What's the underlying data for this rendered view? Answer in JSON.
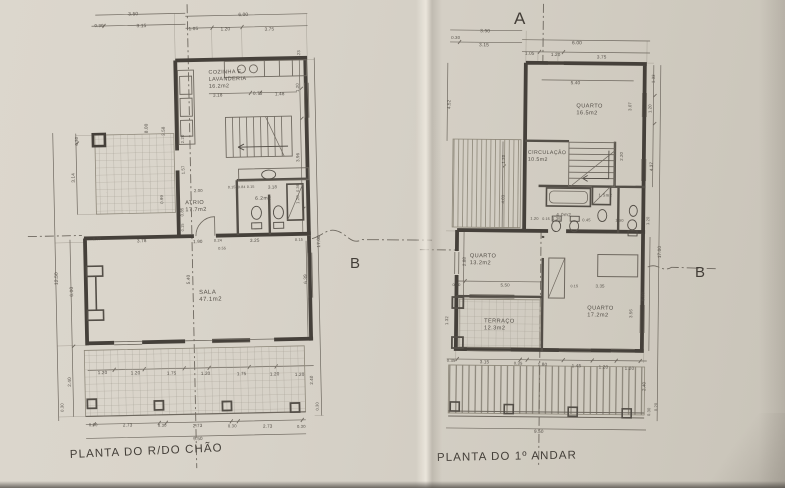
{
  "drawing": {
    "ink_color": "#45403a",
    "paper_color": "#d5cfc5"
  },
  "ground_floor": {
    "title": "PLANTA DO R/DO CHÃO",
    "section_marker_b": "B",
    "room_labels": [
      {
        "lines": [
          "COZINHA  E",
          "LAVANDERIA",
          "16.2m2"
        ],
        "x": 212,
        "y": 74,
        "s": 5.4
      },
      {
        "lines": [
          "ATRIO",
          "17.7m2"
        ],
        "x": 186,
        "y": 204,
        "s": 5.6
      },
      {
        "lines": [
          "6.2m2"
        ],
        "x": 256,
        "y": 201,
        "s": 5
      },
      {
        "lines": [
          "SALA",
          "47.1m2"
        ],
        "x": 198,
        "y": 294,
        "s": 6
      }
    ],
    "dim_labels": [
      {
        "t": "3.50",
        "x": 133,
        "y": 14,
        "s": 4.8
      },
      {
        "t": "0.30",
        "x": 99,
        "y": 25,
        "s": 4.4
      },
      {
        "t": "3.15",
        "x": 141,
        "y": 26,
        "s": 4.8
      },
      {
        "t": "6.00",
        "x": 243,
        "y": 17,
        "s": 4.8
      },
      {
        "t": "1.05",
        "x": 193,
        "y": 30,
        "s": 4.6
      },
      {
        "t": "1.20",
        "x": 225,
        "y": 31,
        "s": 4.6
      },
      {
        "t": "3.75",
        "x": 269,
        "y": 32,
        "s": 4.6
      },
      {
        "t": "12.50",
        "x": 57,
        "y": 282,
        "r": -90,
        "s": 4.8
      },
      {
        "t": "6.00",
        "x": 72,
        "y": 294,
        "r": -90,
        "s": 4.8
      },
      {
        "t": "2.40",
        "x": 68,
        "y": 384,
        "r": -90,
        "s": 4.6
      },
      {
        "t": "0.30",
        "x": 60,
        "y": 409,
        "r": -90,
        "s": 4.2
      },
      {
        "t": "0.30",
        "x": 80,
        "y": 143,
        "r": -90,
        "s": 4.2
      },
      {
        "t": "3.14",
        "x": 76,
        "y": 180,
        "r": -90,
        "s": 4.6
      },
      {
        "t": "8.00",
        "x": 150,
        "y": 132,
        "r": -90,
        "s": 4.6
      },
      {
        "t": "3.58",
        "x": 167,
        "y": 135,
        "r": -90,
        "s": 4.4
      },
      {
        "t": "0.99",
        "x": 164,
        "y": 203,
        "r": -90,
        "s": 4.2
      },
      {
        "t": "2.20",
        "x": 186,
        "y": 143,
        "r": -90,
        "s": 4.2
      },
      {
        "t": "1.57",
        "x": 186,
        "y": 174,
        "r": -90,
        "s": 4.2
      },
      {
        "t": "2.00",
        "x": 195,
        "y": 192,
        "s": 4.2
      },
      {
        "t": "0.85",
        "x": 184,
        "y": 216,
        "r": -90,
        "s": 4.2
      },
      {
        "t": "0.15",
        "x": 184,
        "y": 231,
        "r": -90,
        "s": 3.8
      },
      {
        "t": "3.18",
        "x": 216,
        "y": 97,
        "s": 4.6
      },
      {
        "t": "0.75",
        "x": 256,
        "y": 96,
        "s": 4.6
      },
      {
        "t": "1.48",
        "x": 278,
        "y": 97,
        "s": 4.6
      },
      {
        "t": "1.23",
        "x": 304,
        "y": 61,
        "r": -90,
        "s": 4.2
      },
      {
        "t": "1.20",
        "x": 302,
        "y": 94,
        "r": -90,
        "s": 4.2
      },
      {
        "t": "3.96",
        "x": 301,
        "y": 164,
        "r": -90,
        "s": 4.4
      },
      {
        "t": "1.20",
        "x": 300,
        "y": 206,
        "r": -90,
        "s": 4.2
      },
      {
        "t": "0.15",
        "x": 229,
        "y": 189,
        "s": 3.6
      },
      {
        "t": "0.84",
        "x": 239,
        "y": 189,
        "s": 3.6
      },
      {
        "t": "0.15",
        "x": 248,
        "y": 189,
        "s": 3.6
      },
      {
        "t": "3.18",
        "x": 269,
        "y": 190,
        "s": 4.4
      },
      {
        "t": "0.36",
        "x": 300,
        "y": 194,
        "r": -90,
        "s": 3.8
      },
      {
        "t": "0.30",
        "x": 93,
        "y": 238,
        "s": 3.8
      },
      {
        "t": "3.78",
        "x": 137,
        "y": 241,
        "s": 4.6
      },
      {
        "t": "1.90",
        "x": 193,
        "y": 243,
        "s": 4.6
      },
      {
        "t": "0.24",
        "x": 214,
        "y": 242,
        "s": 3.8
      },
      {
        "t": "0.55",
        "x": 218,
        "y": 250,
        "s": 3.8
      },
      {
        "t": "3.25",
        "x": 250,
        "y": 243,
        "s": 4.6
      },
      {
        "t": "0.15",
        "x": 295,
        "y": 243,
        "s": 3.8
      },
      {
        "t": "5.40",
        "x": 189,
        "y": 284,
        "r": -90,
        "s": 4.6
      },
      {
        "t": "6.39",
        "x": 306,
        "y": 286,
        "r": -90,
        "s": 4.6
      },
      {
        "t": "1.20",
        "x": 95,
        "y": 372,
        "s": 4.6
      },
      {
        "t": "1.20",
        "x": 128,
        "y": 373,
        "s": 4.6
      },
      {
        "t": "1.75",
        "x": 164,
        "y": 374,
        "s": 4.6
      },
      {
        "t": "1.20",
        "x": 198,
        "y": 375,
        "s": 4.6
      },
      {
        "t": "1.75",
        "x": 234,
        "y": 376,
        "s": 4.6
      },
      {
        "t": "1.20",
        "x": 267,
        "y": 377,
        "s": 4.6
      },
      {
        "t": "1.20",
        "x": 292,
        "y": 378,
        "s": 4.6
      },
      {
        "t": "0.30",
        "x": 85,
        "y": 424,
        "s": 4.2
      },
      {
        "t": "2.73",
        "x": 119,
        "y": 425,
        "s": 4.6
      },
      {
        "t": "0.30",
        "x": 154,
        "y": 426,
        "s": 4.2
      },
      {
        "t": "2.73",
        "x": 189,
        "y": 427,
        "s": 4.6
      },
      {
        "t": "0.30",
        "x": 224,
        "y": 428,
        "s": 4.2
      },
      {
        "t": "2.73",
        "x": 259,
        "y": 429,
        "s": 4.6
      },
      {
        "t": "0.30",
        "x": 293,
        "y": 430,
        "s": 4.2
      },
      {
        "t": "9.50",
        "x": 189,
        "y": 440,
        "s": 4.6
      },
      {
        "t": "17.00",
        "x": 320,
        "y": 250,
        "r": -90,
        "s": 4.6
      },
      {
        "t": "2.40",
        "x": 310,
        "y": 387,
        "r": -90,
        "s": 4.4
      },
      {
        "t": "0.30",
        "x": 315,
        "y": 413,
        "r": -90,
        "s": 4
      }
    ]
  },
  "first_floor": {
    "title": "PLANTA DO 1º ANDAR",
    "section_marker_a": "A",
    "section_marker_b": "B",
    "room_labels": [
      {
        "lines": [
          "QUARTO",
          "16.5m2"
        ],
        "x": 575,
        "y": 107,
        "s": 5.6
      },
      {
        "lines": [
          "CIRCULAÇÃO",
          "10.5m2"
        ],
        "x": 527,
        "y": 154,
        "s": 5.2
      },
      {
        "lines": [
          "4.0m2"
        ],
        "x": 556,
        "y": 216,
        "s": 4.6
      },
      {
        "lines": [
          "1.5m2"
        ],
        "x": 598,
        "y": 196,
        "s": 4.2
      },
      {
        "lines": [
          "QUARTO",
          "13.2m2"
        ],
        "x": 470,
        "y": 258,
        "s": 5.6
      },
      {
        "lines": [
          "TERRAÇO",
          "12.3m2"
        ],
        "x": 485,
        "y": 323,
        "s": 5.6
      },
      {
        "lines": [
          "QUARTO",
          "17.2m2"
        ],
        "x": 588,
        "y": 309,
        "s": 5.6
      }
    ],
    "dim_labels": [
      {
        "t": "3.50",
        "x": 478,
        "y": 33,
        "s": 4.8
      },
      {
        "t": "0.30",
        "x": 449,
        "y": 40,
        "s": 4.4
      },
      {
        "t": "3.15",
        "x": 477,
        "y": 47,
        "s": 4.8
      },
      {
        "t": "6.00",
        "x": 570,
        "y": 44,
        "s": 4.8
      },
      {
        "t": "1.05",
        "x": 523,
        "y": 55,
        "s": 4.6
      },
      {
        "t": "1.20",
        "x": 549,
        "y": 56,
        "s": 4.6
      },
      {
        "t": "3.75",
        "x": 595,
        "y": 58,
        "s": 4.6
      },
      {
        "t": "5.40",
        "x": 569,
        "y": 84,
        "s": 4.6
      },
      {
        "t": "1.33",
        "x": 653,
        "y": 82,
        "r": -90,
        "s": 4.2
      },
      {
        "t": "1.20",
        "x": 650,
        "y": 112,
        "r": -90,
        "s": 4.2
      },
      {
        "t": "3.07",
        "x": 630,
        "y": 110,
        "r": -90,
        "s": 4.2
      },
      {
        "t": "4.37",
        "x": 652,
        "y": 170,
        "r": -90,
        "s": 4.4
      },
      {
        "t": "17.00",
        "x": 661,
        "y": 257,
        "r": -90,
        "s": 4.6
      },
      {
        "t": "6.00",
        "x": 645,
        "y": 300,
        "r": -90,
        "s": 4.4
      },
      {
        "t": "3.56",
        "x": 633,
        "y": 317,
        "r": -90,
        "s": 4.2
      },
      {
        "t": "2.40",
        "x": 647,
        "y": 390,
        "r": -90,
        "s": 4.4
      },
      {
        "t": "0.30",
        "x": 652,
        "y": 415,
        "r": -90,
        "s": 4
      },
      {
        "t": "0.20",
        "x": 659,
        "y": 410,
        "r": -90,
        "s": 4
      },
      {
        "t": "4.52",
        "x": 449,
        "y": 110,
        "r": -90,
        "s": 4.4
      },
      {
        "t": "1.20",
        "x": 504,
        "y": 164,
        "r": -90,
        "s": 4.2
      },
      {
        "t": "4.03",
        "x": 504,
        "y": 204,
        "r": -90,
        "s": 4.2
      },
      {
        "t": "2.88",
        "x": 466,
        "y": 267,
        "r": -90,
        "s": 4.4
      },
      {
        "t": "1.32",
        "x": 449,
        "y": 326,
        "r": -90,
        "s": 4.2
      },
      {
        "t": "0.30",
        "x": 453,
        "y": 287,
        "s": 3.8
      },
      {
        "t": "5.50",
        "x": 501,
        "y": 287,
        "s": 4.4
      },
      {
        "t": "2.20",
        "x": 622,
        "y": 160,
        "r": -90,
        "s": 4.2
      },
      {
        "t": "1.20",
        "x": 530,
        "y": 220,
        "s": 4
      },
      {
        "t": "0.15",
        "x": 542,
        "y": 220,
        "s": 3.6
      },
      {
        "t": "1.35",
        "x": 552,
        "y": 220,
        "s": 4
      },
      {
        "t": "0.45",
        "x": 582,
        "y": 221,
        "s": 4
      },
      {
        "t": "1.50",
        "x": 615,
        "y": 221,
        "s": 4
      },
      {
        "t": "1.20",
        "x": 649,
        "y": 224,
        "r": -90,
        "s": 4
      },
      {
        "t": "0.15",
        "x": 571,
        "y": 287,
        "s": 3.6
      },
      {
        "t": "3.35",
        "x": 596,
        "y": 287,
        "s": 4.4
      },
      {
        "t": "0.35",
        "x": 448,
        "y": 363,
        "s": 4.2
      },
      {
        "t": "3.15",
        "x": 481,
        "y": 364,
        "s": 4.6
      },
      {
        "t": "0.35",
        "x": 515,
        "y": 365,
        "s": 4.2
      },
      {
        "t": "1.80",
        "x": 539,
        "y": 366,
        "s": 4.6
      },
      {
        "t": "1.45",
        "x": 573,
        "y": 367,
        "s": 4.6
      },
      {
        "t": "1.20",
        "x": 600,
        "y": 368,
        "s": 4.6
      },
      {
        "t": "1.20",
        "x": 626,
        "y": 369,
        "s": 4.6
      },
      {
        "t": "9.50",
        "x": 536,
        "y": 433,
        "s": 4.6
      }
    ]
  }
}
